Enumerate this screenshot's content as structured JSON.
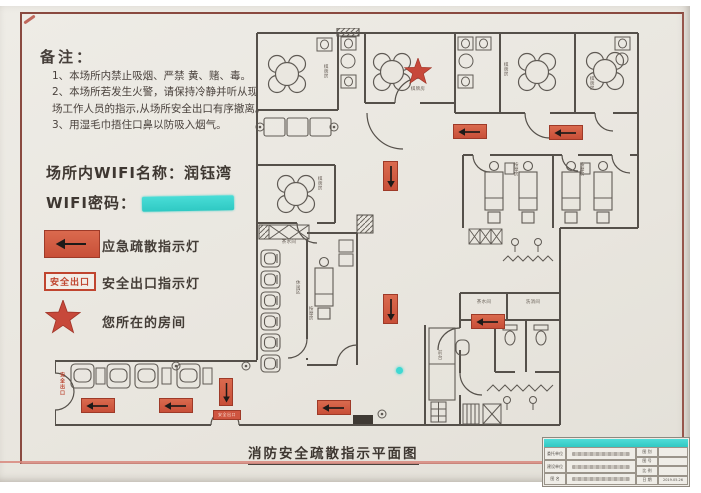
{
  "notes": {
    "heading": "备注：",
    "item1": "1、本场所内禁止吸烟、严禁 黄、赌、毒。",
    "item2": "2、本场所若发生火警，请保持冷静并听从现场工作人员的指示,从场所安全出口有序撤离。",
    "item3": "3、用湿毛巾捂住口鼻以防吸入烟气。"
  },
  "wifi": {
    "name_label": "场所内WIFI名称：",
    "name_value": "润钰湾",
    "password_label": "WIFI密码：",
    "password_redacted": true
  },
  "legend": {
    "evac_light_label": "应急疏散指示灯",
    "exit_sign_text": "安全出口",
    "exit_light_label": "安全出口指示灯",
    "you_are_here_label": "您所在的房间"
  },
  "plan": {
    "title": "消防安全疏散指示平面图",
    "labels": {
      "card_room": "棋牌房",
      "massage_room": "按摩房",
      "lounge": "休闲区",
      "pantry": "茶水间",
      "sanitize": "洗消间",
      "front_desk": "前台",
      "exit": "安全出口"
    }
  },
  "title_block": {
    "header_redacted": true,
    "left_rows": [
      {
        "label": "委托单位"
      },
      {
        "label": "建设单位"
      },
      {
        "label": "图 名"
      }
    ],
    "right_rows": [
      {
        "label": "图 别",
        "value": ""
      },
      {
        "label": "图 号",
        "value": ""
      },
      {
        "label": "比 例",
        "value": ""
      },
      {
        "label": "日 期",
        "value": "2019.05.26"
      }
    ]
  },
  "colors": {
    "sign_red": "#d0573f",
    "star_red": "#c7483a",
    "redaction_cyan": "#3fd8d2",
    "wall_gray": "#55504a",
    "paper": "#eae7e0"
  }
}
